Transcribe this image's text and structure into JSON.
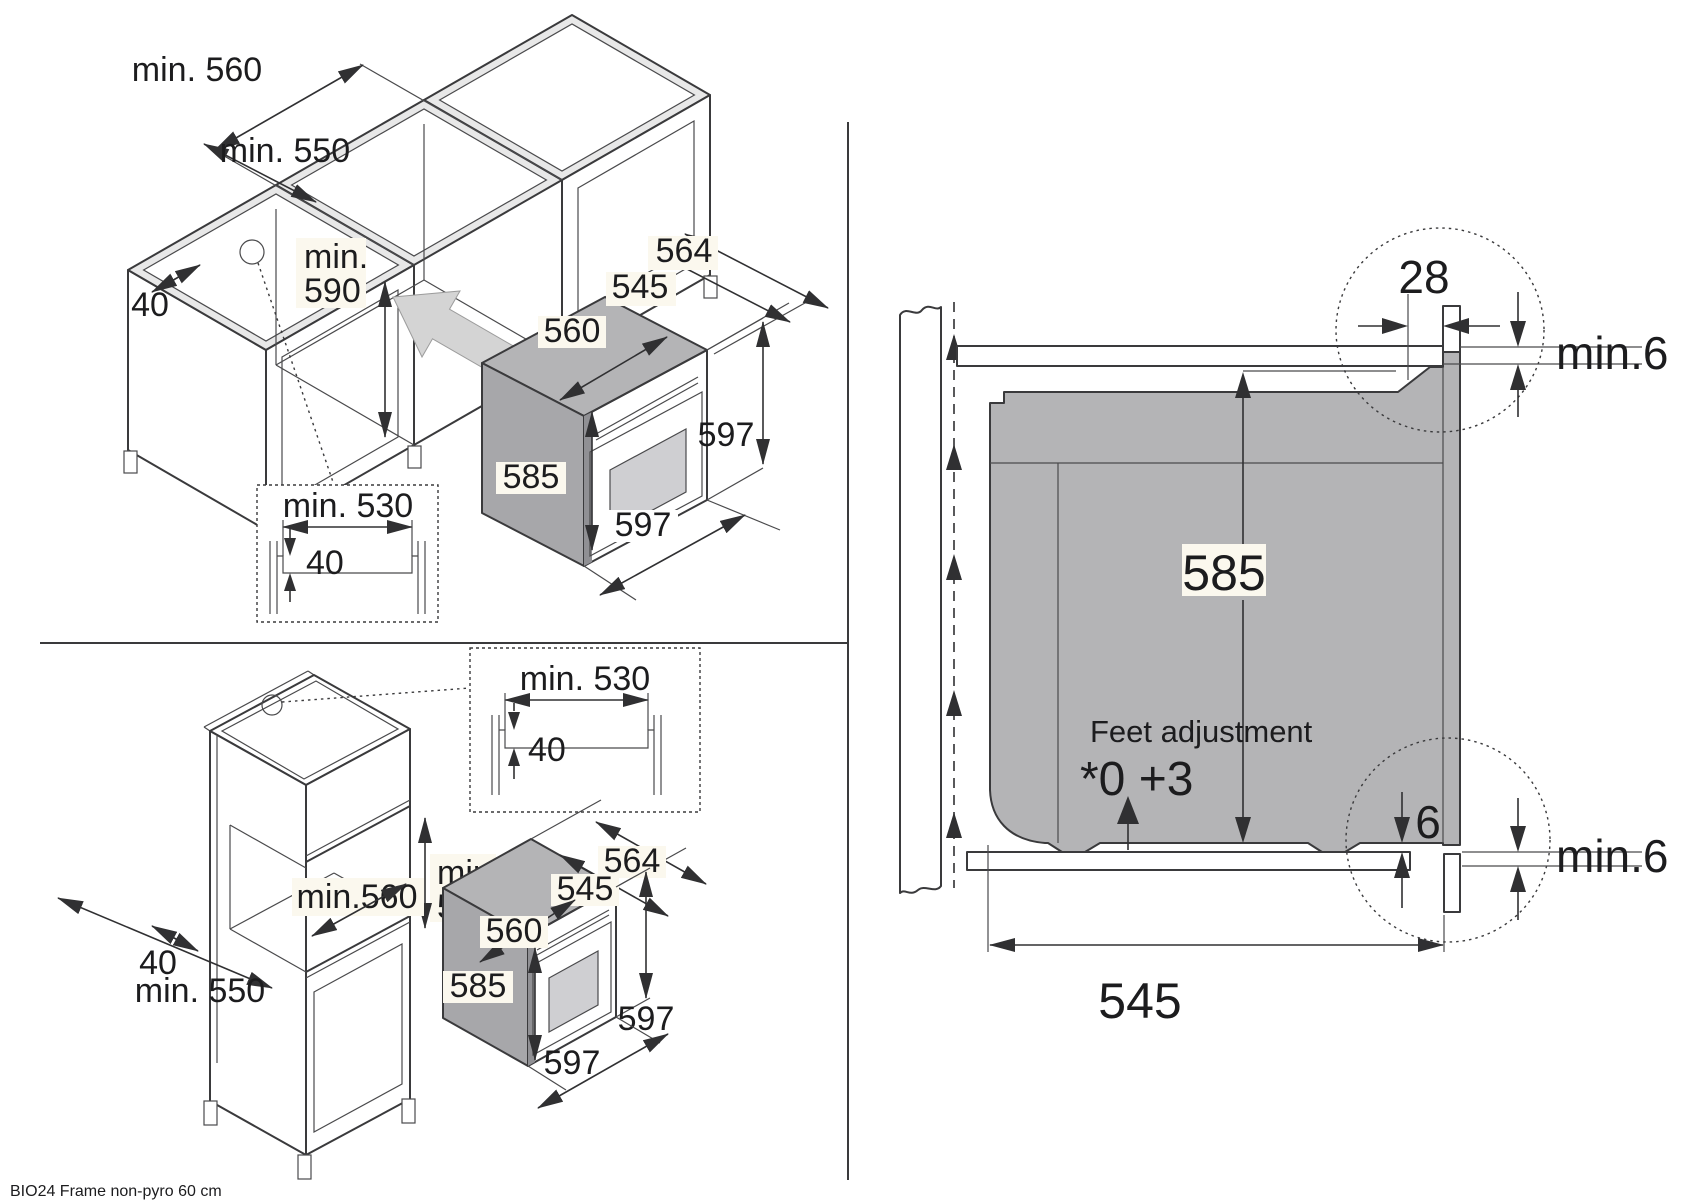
{
  "footer": {
    "label": "BIO24 Frame non-pyro 60 cm"
  },
  "colors": {
    "line": "#3a3a3c",
    "oven_gray": "#b4b4b6",
    "oven_gray_dark": "#a7a7aa",
    "rail_gray": "#e8e8e8",
    "arrow_gray": "#d4d4d4",
    "glass": "#cfcfd2",
    "label_bg": "#fbf8ee"
  },
  "base_view": {
    "min_width": "min. 560",
    "min_depth": "min. 550",
    "min_height_l1": "min.",
    "min_height_l2": "590",
    "rail": "40",
    "inset_width": "min. 530",
    "inset_depth": "40",
    "oven": {
      "d564": "564",
      "d545": "545",
      "d560": "560",
      "d585": "585",
      "d597r": "597",
      "d597b": "597"
    }
  },
  "tall_view": {
    "min_height_l1": "min.",
    "min_height_l2": "590",
    "min_width": "min.560",
    "rail": "40",
    "min_depth": "min. 550",
    "inset_width": "min. 530",
    "inset_depth": "40",
    "oven": {
      "d564": "564",
      "d545": "545",
      "d560": "560",
      "d585": "585",
      "d597r": "597",
      "d597b": "597"
    }
  },
  "section_view": {
    "d28": "28",
    "top_gap": "min.6",
    "d585": "585",
    "feet_l1": "Feet adjustment",
    "feet_l2": "*0 +3",
    "d6": "6",
    "bottom_gap": "min.6",
    "d545": "545"
  }
}
